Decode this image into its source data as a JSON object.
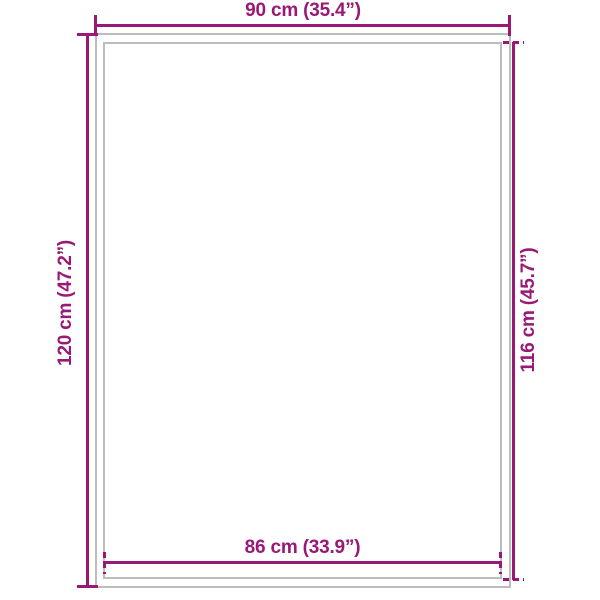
{
  "diagram": {
    "type": "product-dimension-diagram",
    "colors": {
      "accent": "#9a1876",
      "outline_gray": "#bdbdbd",
      "background": "#ffffff"
    },
    "dimensions": {
      "top": {
        "label": "90 cm (35.4”)",
        "measures": "outer width"
      },
      "left": {
        "label": "120 cm (47.2”)",
        "measures": "outer height"
      },
      "right": {
        "label": "116 cm (45.7”)",
        "measures": "inner height"
      },
      "bottom": {
        "label": "86 cm (33.9”)",
        "measures": "inner width"
      }
    }
  }
}
